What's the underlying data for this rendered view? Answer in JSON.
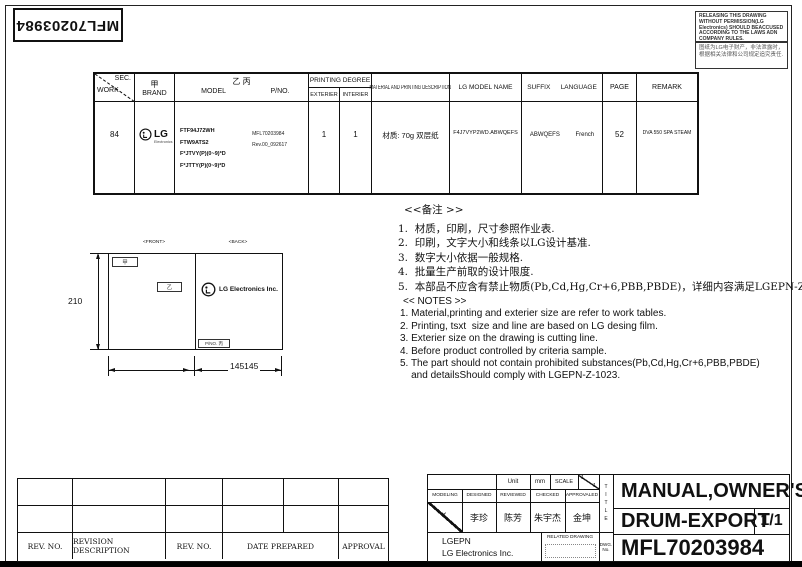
{
  "page": {
    "corner_pno": "MFL70203984",
    "notice_en": "RELEASING THIS DRAWING WITHOUT PERMISSION(LG Electronics) SHOULD BEACCUSED ACCORDING TO THE LAWS ADN COMPANY RULES.",
    "notice_cn_line1": "图纸为LG电子财产，非法泄露时，",
    "notice_cn_line2": "根据相关法律和公司规定追究责任."
  },
  "spec_table": {
    "headers": {
      "sec": "SEC.",
      "work": "WORK",
      "brand_mark": "甲",
      "brand": "BRAND",
      "model_mark": "乙 丙",
      "model": "MODEL",
      "pno": "P/NO.",
      "printing_degree": "PRINTING DEGREE",
      "exterier": "EXTERIER",
      "interier": "INTERIER",
      "material": "MATERIAL AND PRINTING DESCRIPTION",
      "lg_model_name": "LG MODEL NAME",
      "suffix": "SUFFIX",
      "language": "LANGUAGE",
      "page": "PAGE",
      "remark": "REMARK"
    },
    "row": {
      "work": "84",
      "brand_logo": "LG",
      "brand_logo_sub": "Electronics",
      "models": [
        "FTF94J72WH",
        "FTW9ATS2",
        "F*JTVY(P)(0~9)*D",
        "F*JTTY(P)(0~9)*D"
      ],
      "pno_line1": "MFL70203984",
      "pno_line2": "Rev.00_092617",
      "exterier": "1",
      "interier": "1",
      "material": "材质: 70g 双层纸",
      "lg_model_name": "F4J7VYP2WD.ABWQEFS",
      "suffix": "ABWQEFS",
      "language": "French",
      "page": "52",
      "remark": "DVA 550 SPA STEAM"
    }
  },
  "notes_cn": {
    "title": "<<备注 >>",
    "items": [
      "1.  材质，印刷，尺寸参照作业表.",
      "2.  印刷，文字大小和线条以LG设计基准.",
      "3.  数字大小依据一般规格.",
      "4.  批量生产前取的设计限度.",
      "5.  本部品不应含有禁止物质(Pb,Cd,Hg,Cr+6,PBB,PBDE)，详细内容满足LGEPN-Z-1023."
    ]
  },
  "notes_en": {
    "title": "<< NOTES >>",
    "items": [
      "1. Material,printing and exterier size are refer to work tables.",
      "2. Printing, tsxt  size and line are based on LG desing film.",
      "3. Exterier size on the drawing is cutting line.",
      "4. Before product controlled by criteria sample.",
      "5. The part should not contain prohibited substances(Pb,Cd,Hg,Cr+6,PBB,PBDE)",
      "    and detailsShould comply with LGEPN-Z-1023."
    ]
  },
  "drawing": {
    "front_label": "<FRONT>",
    "back_label": "<BACK>",
    "marker_brand": "甲",
    "marker_model": "乙",
    "logo_text": "LG Electronics Inc.",
    "pno_box": "P/NO. 丙",
    "dim_height": "210",
    "dim_width": "145145"
  },
  "revision_table": {
    "col1": "REV. NO.",
    "col2": "REVISION DESCRIPTION",
    "col3": "REV. NO.",
    "col4": "DATE PREPARED",
    "col5": "APPROVAL"
  },
  "title_block": {
    "unit_label": "Unit",
    "unit_value": "mm",
    "scale_label": "SCALE",
    "scale_num": "1",
    "scale_den": "1",
    "modeling": "MODELING",
    "designed": "DESIGNED",
    "reviewed": "REVIEWED",
    "checked": "CHECKED",
    "approvaled": "APPROVALED",
    "modeling_mark": "✕",
    "designed_name": "李珍",
    "reviewed_name": "陈芳",
    "checked_name": "朱宇杰",
    "approvaled_name": "金坤",
    "company_line1": "LGEPN",
    "company_line2": "LG Electronics Inc.",
    "related_drawing": "RELATED DRAWING",
    "title_label": "TITLE",
    "dwg_label1": "DWG.",
    "dwg_label2": "No.",
    "title_line1": "MANUAL,OWNER'S",
    "title_line2": "DRUM-EXPORT",
    "sheet": "1/1",
    "dwg_no": "MFL70203984"
  }
}
